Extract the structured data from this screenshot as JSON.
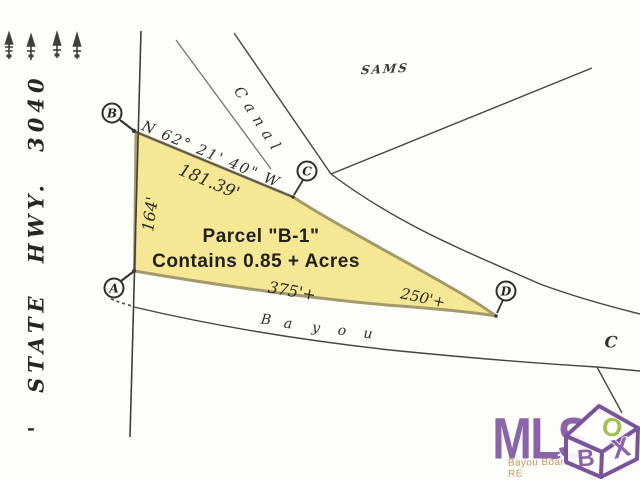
{
  "labels": {
    "road": "' STATE HWY. 3040",
    "canal": "Canal",
    "sams": "SAMS",
    "bearing": "N 62° 21' 40\" W",
    "dist_top": "181.39'",
    "dist_left": "164'",
    "dist_bottom_left": "375'+",
    "dist_bottom_right": "250'+",
    "parcel_title": "Parcel \"B-1\"",
    "parcel_area": "Contains 0.85 + Acres",
    "bayou_c": "C"
  },
  "bayou_letters": [
    "B",
    "a",
    "y",
    "o",
    "u"
  ],
  "corners": [
    {
      "label": "A"
    },
    {
      "label": "B"
    },
    {
      "label": "C"
    },
    {
      "label": "D"
    }
  ],
  "watermark": {
    "brand": "MLS",
    "cube_top_letter": "O",
    "cube_left_letter": "B",
    "cube_right_letter": "X",
    "subtext": "Bayou Board of RE",
    "purple": "#8b65a7",
    "green": "#9fc24c",
    "tan": "#c9935f"
  },
  "colors": {
    "background": "#fdfdfa",
    "parcel_fill": "#f6e795",
    "parcel_stroke": "#a39a6b",
    "line": "#45443f",
    "text": "#2b2b26"
  }
}
